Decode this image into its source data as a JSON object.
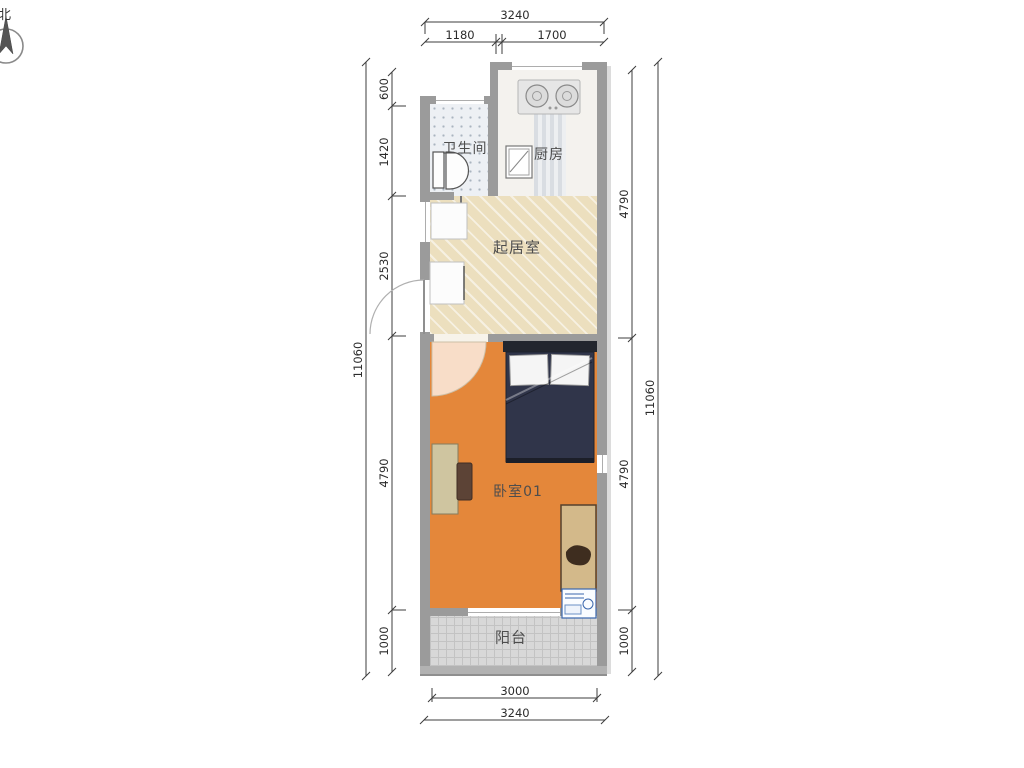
{
  "compass": {
    "label": "北"
  },
  "rooms": {
    "bathroom": {
      "label": "卫生间"
    },
    "kitchen": {
      "label": "厨房"
    },
    "living_room": {
      "label": "起居室"
    },
    "bedroom": {
      "label": "卧室01"
    },
    "balcony": {
      "label": "阳台"
    }
  },
  "dimensions": {
    "top": {
      "overall": "3240",
      "segments": [
        "1180",
        "1700"
      ]
    },
    "bottom": {
      "inner_width": "3000",
      "overall": "3240"
    },
    "left": {
      "overall": "11060",
      "segments": [
        "600",
        "1420",
        "2530",
        "4790",
        "1000"
      ]
    },
    "right": {
      "overall": "11060",
      "segments": [
        "4790",
        "4790",
        "1000"
      ]
    }
  },
  "colors": {
    "wall": "#9b9b9b",
    "bedroom_floor": "#e4873a",
    "living_floor": "#ecdfbe",
    "balcony_floor": "#d8d8d8",
    "bathroom_floor": "#edf0f4",
    "bed_duvet": "#30354a",
    "dimension_text": "#2b2b2b"
  }
}
